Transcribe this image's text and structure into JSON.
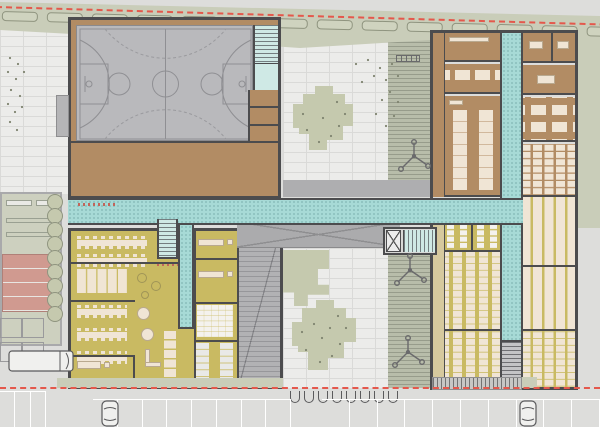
{
  "colors": {
    "site_bg": "#dddddb",
    "paving": "#ececea",
    "paving_line": "#dadad8",
    "green_band": "#c9cdb9",
    "hedge_line": "#8f947f",
    "boundary_red": "#e4584c",
    "wall": "#4c4c4e",
    "gym_floor": "#b9b9bc",
    "court_line": "#8f8f93",
    "corridor": "#a7dad6",
    "stair_light": "#cfe9e5",
    "brown_room": "#b28c64",
    "yellow_room": "#c9ba62",
    "furniture": "#f0e5d5",
    "furniture_line": "#b9a98f",
    "canopy_gray": "#ababad",
    "ramp_gray": "#b2b2b4",
    "walk_gray": "#aeaeb0",
    "hatch_green": "#b8bdaa",
    "khaki_strip": "#d6c99e",
    "tree_fill": "#c5c9ae",
    "tree_dot": "#7f8470",
    "field_green": "#cdd0bf",
    "track_pink": "#d09a90",
    "asphalt": "#dcdcda",
    "elevator_bg": "#ececec",
    "stair_marker_blue": "#4a7fd4"
  },
  "repeat": {
    "hedges": 15,
    "hedge_bubbles": 9,
    "bike_racks": 8,
    "stalls_left": 8,
    "stalls_right": 10,
    "stalls_far_left": 3,
    "dining_tables": 3,
    "banquet_tables": 2
  },
  "site": {
    "boundary": "red dashed property line, diagonal at top and horizontal at bottom",
    "landscape": "green hedge band along north edge with 15 hedge capsules",
    "sports_field": {
      "position": "west edge",
      "track_lanes": 4,
      "track_color_key": "track_pink"
    },
    "parking": {
      "left_stalls": 8,
      "right_stalls": 10,
      "far_left_stalls": 3,
      "cars": 2,
      "bus": 1
    },
    "bike_racks": 8,
    "trees": [
      "northwest cluster",
      "upper courtyard tree",
      "lower courtyard tree",
      "east planting cluster"
    ],
    "play_equipment": {
      "tripod_climbers": 3,
      "ladder_bench": 1
    },
    "courtyards": 2
  },
  "building": {
    "gym_block": {
      "use": "sports hall with basketball court",
      "floor_key": "gym_floor",
      "annex": "changing rooms (brown)",
      "stair": "northeast corner"
    },
    "north_east_wing": {
      "use": "staff / admin rooms",
      "color_key": "brown_room",
      "left_rooms": 3,
      "right_rooms": 4
    },
    "south_east_wing": {
      "use": "classrooms with desk rows + toilets",
      "color_key": "yellow_room",
      "classrooms": 5,
      "toilet_blocks": 1
    },
    "south_west_wing": {
      "use": "canteen / dining with kitchen, offices, toilets",
      "color_key": "yellow_room"
    },
    "circulation": {
      "color_key": "corridor",
      "texture": "dotted",
      "main_corridor": "east-west spine",
      "vertical_corridors": 2,
      "stairs": 4,
      "elevators": 1
    },
    "canopy": {
      "marking": "X-braced flat roof over entry zone",
      "color_key": "canopy_gray"
    },
    "ramp_hall": {
      "use": "tiered / ramped hall strip",
      "color_key": "ramp_gray"
    }
  }
}
